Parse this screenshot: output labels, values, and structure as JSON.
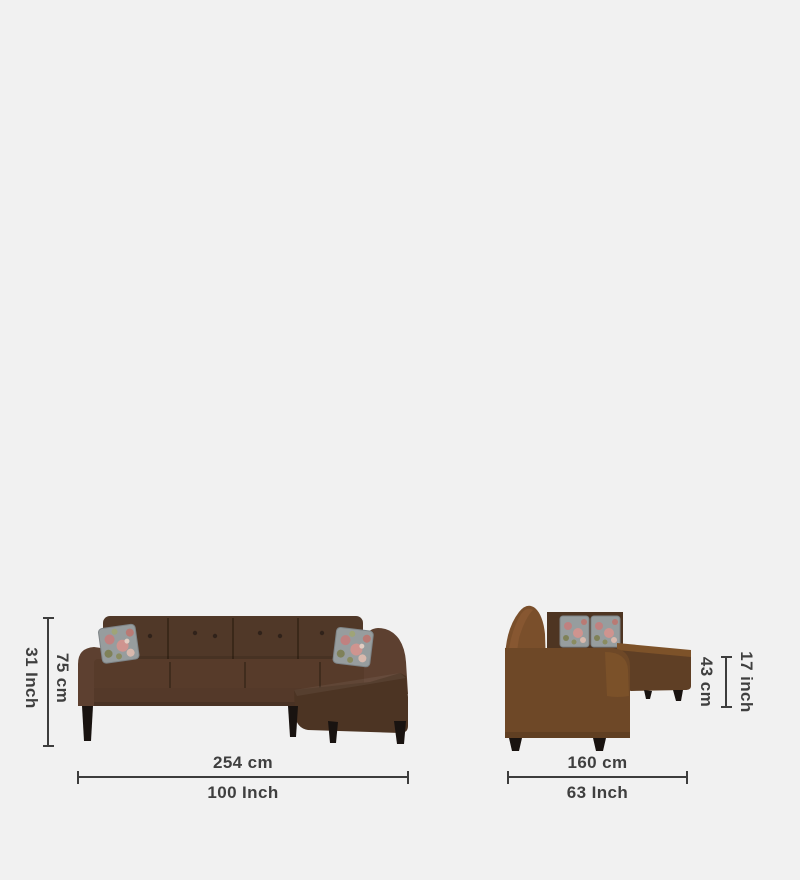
{
  "background_color": "#f1f1f1",
  "annotation": {
    "line_color": "#3d3d3d",
    "text_color": "#3f3f3f"
  },
  "front_view": {
    "height_cm": "75 cm",
    "height_inch": "31 Inch",
    "width_cm": "254 cm",
    "width_inch": "100 Inch"
  },
  "side_view": {
    "height_cm": "43 cm",
    "height_inch": "17 inch",
    "width_cm": "160 cm",
    "width_inch": "63 Inch"
  },
  "sofa": {
    "colors": {
      "back_panel": "#503828",
      "cushion_seam": "#3a2819",
      "body": "#5a3e2b",
      "arm": "#5d4030",
      "seat": "#573b2a",
      "rail": "#543929",
      "chaise_front": "#4c3423",
      "side_back": "#7a4f2b",
      "side_back_highlight": "#875731",
      "side_backrest": "#4e3522",
      "side_body": "#6e4827",
      "side_bulge": "#7b5129",
      "side_chaise_top": "#7d5229",
      "side_chaise_front": "#5f3f25",
      "legs": "#191310",
      "pillow_base": "#979d9e",
      "pillow_edge": "#7e8487",
      "flower_pink": "#c08180",
      "flower_rose": "#cf948f",
      "flower_deep": "#b97a74",
      "flower_cream": "#d9b9ad",
      "leaf_olive": "#7f8158",
      "leaf_light": "#9fa477"
    }
  }
}
